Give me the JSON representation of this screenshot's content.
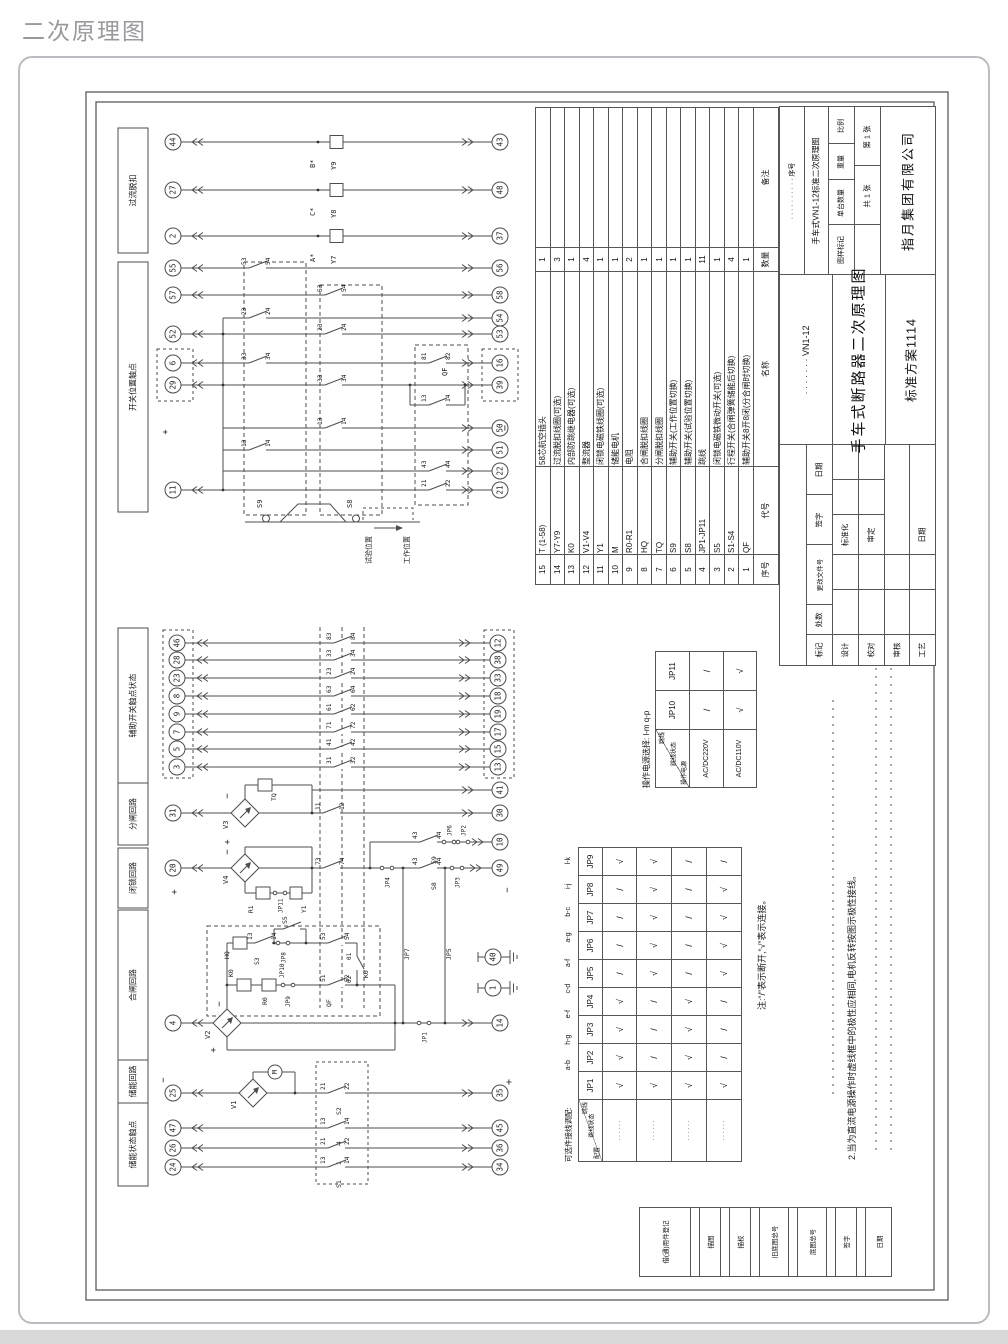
{
  "page": {
    "title": "二次原理图"
  },
  "sections": [
    "过流脱扣",
    "开关位置触点",
    "辅助开关触点状态",
    "分闸回路",
    "闭锁回路",
    "合闸回路",
    "储能回路",
    "储能状态触点"
  ],
  "overcurrent": [
    {
      "left": "44",
      "right": "43",
      "phase": "B*",
      "coil": "Y9"
    },
    {
      "left": "27",
      "right": "48",
      "phase": "C*",
      "coil": "Y8"
    },
    {
      "left": "2",
      "right": "37",
      "phase": "A*",
      "coil": "Y7"
    }
  ],
  "switch_position": {
    "qf_label": "QF",
    "plus": "+",
    "minus": "−",
    "rows": [
      {
        "left": "55",
        "right": "56",
        "t": "53",
        "b": "54"
      },
      {
        "left": "57",
        "right": "58",
        "t": "53",
        "b": "54"
      },
      {
        "left": "",
        "right": "54",
        "t": "23",
        "b": "24"
      },
      {
        "left": "52",
        "right": "53",
        "t": "23",
        "b": "24"
      },
      {
        "left": "6",
        "right": "16",
        "t": "33",
        "b": "34",
        "t2": "81",
        "b2": "82"
      },
      {
        "left": "29",
        "right": "39",
        "t": "33",
        "b": "34"
      },
      {
        "left": "",
        "right": "",
        "t": "13",
        "b": "14"
      },
      {
        "left": "",
        "right": "50",
        "t": "13",
        "b": "14"
      },
      {
        "left": "",
        "right": "51",
        "t": "13",
        "b": "14"
      },
      {
        "left": "",
        "right": "22",
        "t": "43",
        "b": "44"
      },
      {
        "left": "11",
        "right": "21",
        "t": "21",
        "b": "22"
      }
    ],
    "cam": {
      "s9": "S9",
      "s8": "S8",
      "test": "试验位置",
      "work": "工作位置"
    }
  },
  "aux": {
    "rows": [
      {
        "left": "46",
        "right": "12",
        "t": "83",
        "b": "84"
      },
      {
        "left": "28",
        "right": "38",
        "t": "33",
        "b": "34"
      },
      {
        "left": "23",
        "right": "33",
        "t": "23",
        "b": "24"
      },
      {
        "left": "8",
        "right": "18",
        "t": "63",
        "b": "64"
      },
      {
        "left": "9",
        "right": "19",
        "t": "61",
        "b": "62"
      },
      {
        "left": "7",
        "right": "17",
        "t": "71",
        "b": "72"
      },
      {
        "left": "5",
        "right": "15",
        "t": "41",
        "b": "42"
      },
      {
        "left": "3",
        "right": "13",
        "t": "31",
        "b": "32"
      }
    ]
  },
  "opening": {
    "left": "31",
    "branch": "41",
    "right": "30",
    "rect": "V3",
    "coil": "TQ",
    "t": "11",
    "b": "12",
    "plus": "+",
    "minus": "−"
  },
  "locking": {
    "left": "20",
    "out_top": "10",
    "out": "49",
    "rect": "V4",
    "res": "R1",
    "jp11": "JP11",
    "coil": "Y1",
    "t": "73",
    "b": "74",
    "jp4": "JP4",
    "s9": "S9",
    "s8": "S8",
    "ct": "43",
    "cb": "44",
    "jp6": "JP6",
    "jp2": "JP2",
    "jp3": "JP3",
    "jp7": "JP7",
    "jp5": "JP5",
    "plus": "+",
    "minus": "−"
  },
  "closing": {
    "left": "4",
    "right": "14",
    "rect": "V2",
    "hq": "HQ",
    "s3": "S3",
    "s3t": "13",
    "s3b": "14",
    "jp8": "JP8",
    "s5": "S5",
    "qt": "53",
    "qb": "54",
    "k01": "01",
    "k02": "02",
    "k0c": "K0",
    "k0": "K0",
    "r0": "R0",
    "jp10": "JP10",
    "jp9": "JP9",
    "q2t": "51",
    "q2b": "52",
    "qf": "QF",
    "jp1": "JP1",
    "plus": "+",
    "minus": "−",
    "gnd1": "40",
    "gnd2": "1"
  },
  "storage": {
    "left": "25",
    "right": "35",
    "rect": "V1",
    "motor": "M",
    "t": "21",
    "b": "22",
    "sw": "S2",
    "plus": "+",
    "minus": "−",
    "rows": [
      {
        "left": "47",
        "right": "45",
        "t": "13",
        "b": "14",
        "sw": "S4"
      },
      {
        "left": "26",
        "right": "36",
        "t": "21",
        "b": "22",
        "sw": "S1"
      },
      {
        "left": "24",
        "right": "34",
        "t": "13",
        "b": "14",
        "sw": "S1"
      }
    ]
  },
  "power_table": {
    "title": "操作电源选择: l-m  q-p",
    "corner": [
      "跳线",
      "跳线状态",
      "操作电源"
    ],
    "cols": [
      "JP10",
      "JP11"
    ],
    "rows": [
      [
        "AC/DC220V",
        "/",
        "/"
      ],
      [
        "AC/DC110V",
        "√",
        "√"
      ]
    ]
  },
  "jumper_table": {
    "title_prefix": "可选件接线调配:",
    "codes": [
      "a-b",
      "h-g",
      "e-f",
      "c-d",
      "a-f",
      "a-g",
      "b-c",
      "i-j",
      "l-k"
    ],
    "corner": [
      "跳线",
      "跳线状态",
      "配置"
    ],
    "cols": [
      "JP1",
      "JP2",
      "JP3",
      "JP4",
      "JP5",
      "JP6",
      "JP7",
      "JP8",
      "JP9"
    ],
    "row_label": "· · · · · ·",
    "rows": [
      [
        "√",
        "√",
        "√",
        "√",
        "/",
        "/",
        "/",
        "/",
        "√"
      ],
      [
        "√",
        "/",
        "/",
        "/",
        "√",
        "√",
        "√",
        "√",
        "√"
      ],
      [
        "√",
        "√",
        "√",
        "√",
        "/",
        "/",
        "/",
        "/",
        "/"
      ],
      [
        "√",
        "/",
        "/",
        "/",
        "√",
        "√",
        "√",
        "√",
        "/"
      ]
    ]
  },
  "notes": [
    "注:“/”表示断开,“√”表示连接。",
    "2.当为直流电源操作时虚线框中的极性应相同,电机反转按图示极性接线。"
  ],
  "bom": {
    "headers": [
      "序号",
      "代号",
      "名称",
      "数量",
      "备注"
    ],
    "rows": [
      [
        "15",
        "T (1-58)",
        "58芯航空插头",
        "1",
        ""
      ],
      [
        "14",
        "Y7-Y9",
        "过流脱扣线圈(可选)",
        "3",
        ""
      ],
      [
        "13",
        "K0",
        "内部防跳继电器(可选)",
        "1",
        ""
      ],
      [
        "12",
        "V1-V4",
        "整流器",
        "4",
        ""
      ],
      [
        "11",
        "Y1",
        "闭锁电磁铁线圈(可选)",
        "1",
        ""
      ],
      [
        "10",
        "M",
        "储能电机",
        "1",
        ""
      ],
      [
        "9",
        "R0-R1",
        "电阻",
        "2",
        ""
      ],
      [
        "8",
        "HQ",
        "合闸脱扣线圈",
        "1",
        ""
      ],
      [
        "7",
        "TQ",
        "分闸脱扣线圈",
        "1",
        ""
      ],
      [
        "6",
        "S9",
        "辅助开关(工作位置切换)",
        "1",
        ""
      ],
      [
        "5",
        "S8",
        "辅助开关(试验位置切换)",
        "1",
        ""
      ],
      [
        "4",
        "JP1-JP11",
        "跳线",
        "11",
        ""
      ],
      [
        "3",
        "S5",
        "闭锁电磁铁微动开关(可选)",
        "1",
        ""
      ],
      [
        "2",
        "S1-S4",
        "行程开关(合闸弹簧储能后切换)",
        "4",
        ""
      ],
      [
        "1",
        "QF",
        "辅助开关8开8闭(分合闸时切换)",
        "1",
        ""
      ]
    ]
  },
  "titleblock": {
    "seq_dots": "· · · · · · · · · ·  序号",
    "product": "手车式VN1-12标准二次原理图",
    "field_mark": "图样标记",
    "field_qty": "单台数量",
    "field_weight": "重量",
    "field_scale": "比例",
    "sheets": "共 1 张",
    "sheet_no": "第 1 张",
    "company": "指月集团有限公司",
    "model": "· · · · · · ·  VN1-12",
    "title": "手车式断路器二次原理图",
    "scheme": "标准方案1114",
    "sig_mark": "标记",
    "sig_count": "处数",
    "sig_change": "更改文件号",
    "sig_sign": "签字",
    "sig_date": "日期",
    "sig_design": "设计",
    "sig_check": "校对",
    "sig_audit": "审核",
    "sig_craft": "工艺",
    "sig_std": "标准化",
    "sig_approve": "审定",
    "sig_date2": "日期"
  },
  "margin_strip": [
    "借(通)用件登记",
    "描图",
    "描校",
    "旧底图总号",
    "底图总号",
    "签字",
    "日期"
  ]
}
